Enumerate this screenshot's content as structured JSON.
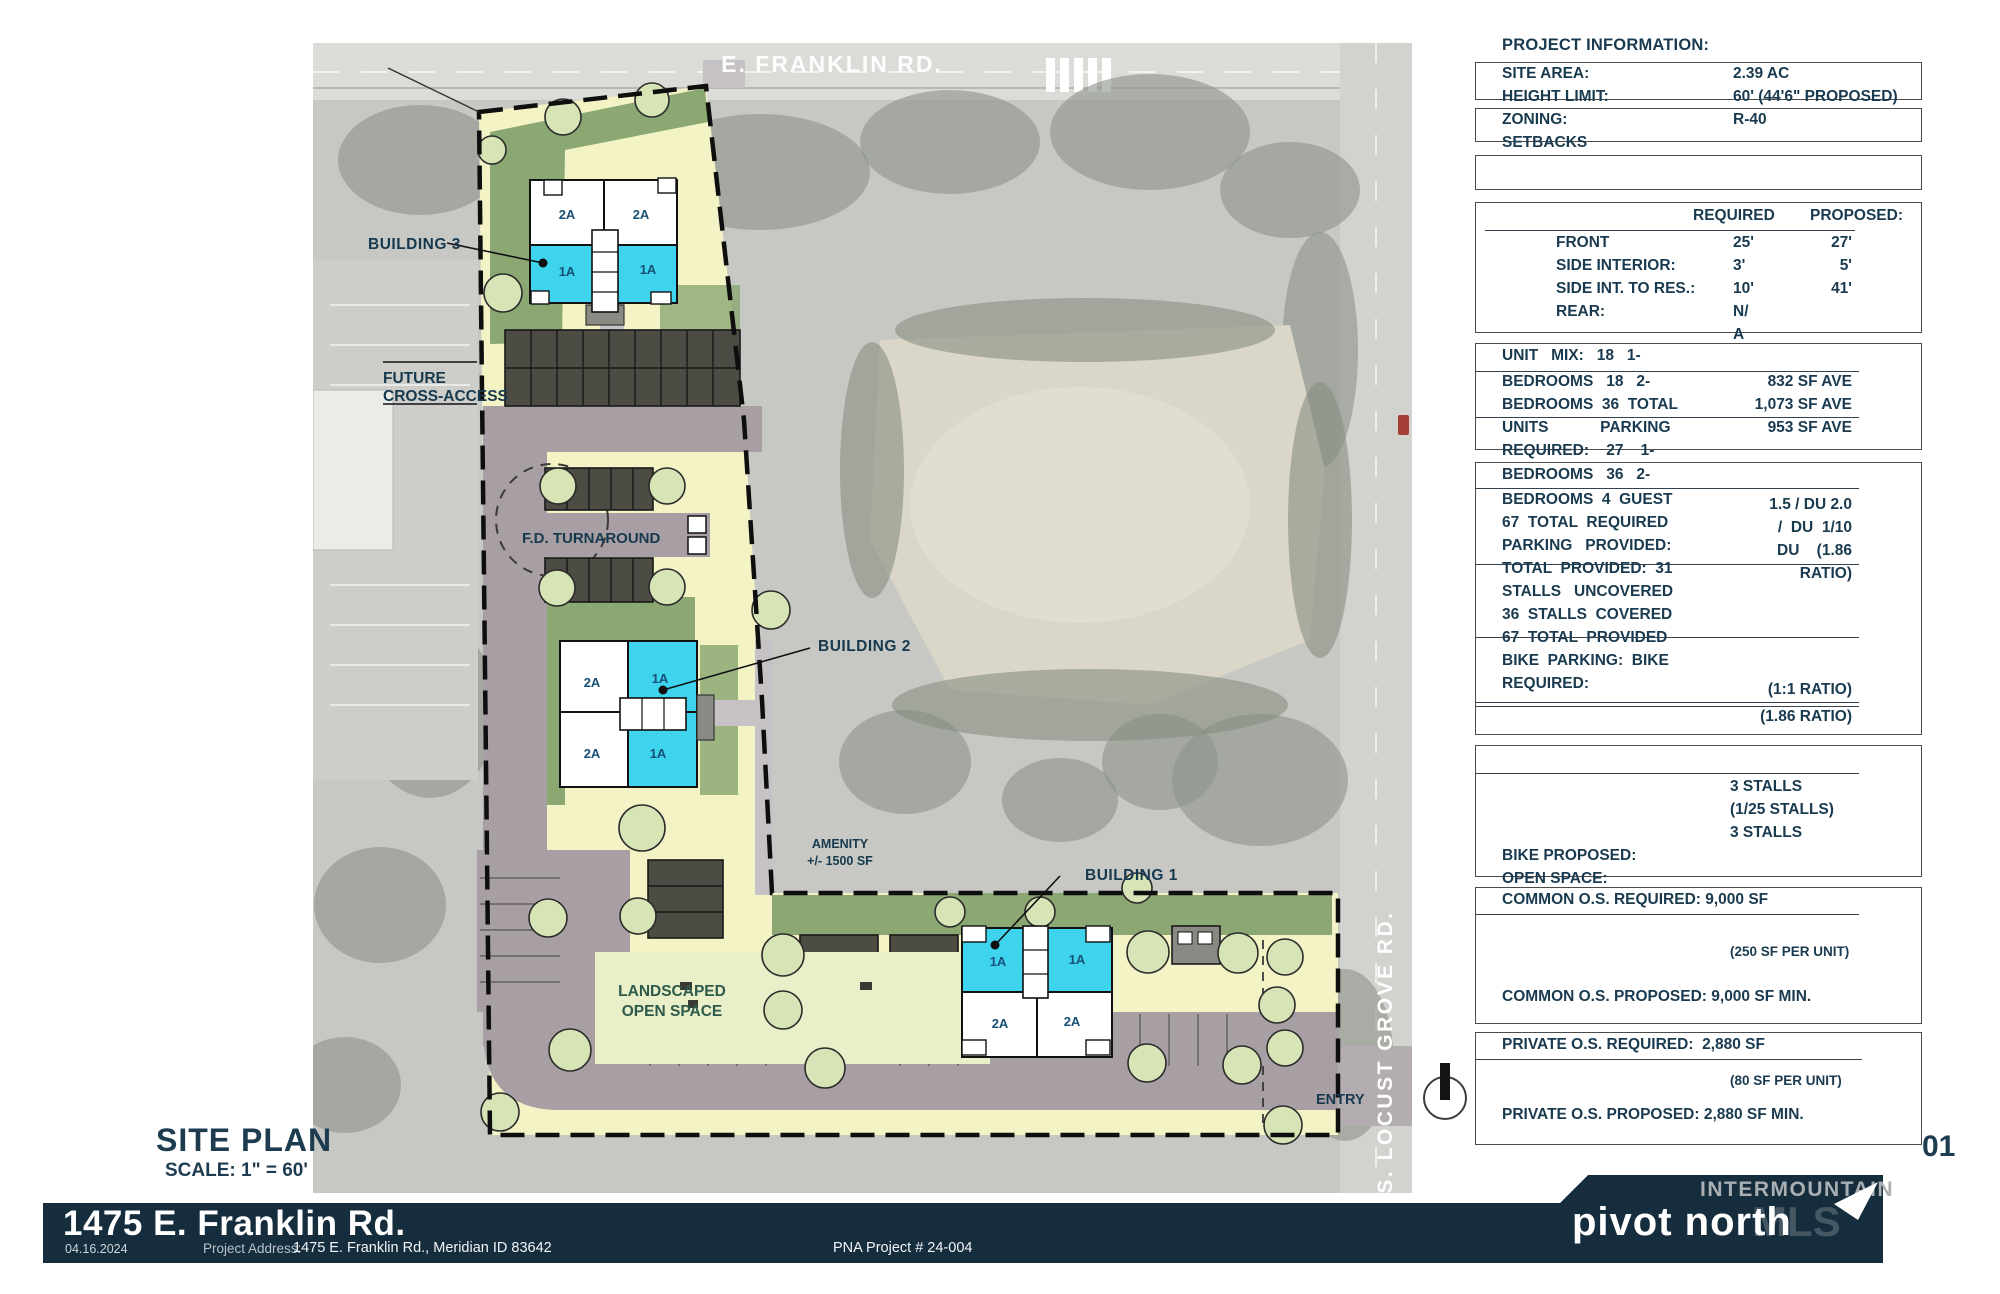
{
  "sheet": {
    "title": "SITE PLAN",
    "scale": "SCALE: 1\" = 60'",
    "sheet_number": "01",
    "date": "04.16.2024",
    "project_title": "1475 E. Franklin Rd.",
    "address_label": "Project Address:",
    "address": "1475 E. Franklin Rd., Meridian ID 83642",
    "project_number": "PNA Project # 24-004",
    "logo_text": "pivot north",
    "watermark_line1": "INTERMOUNTAIN",
    "watermark_line2": "MLS"
  },
  "plan": {
    "roads": {
      "top": "E. FRANKLIN RD.",
      "right": "S. LOCUST GROVE RD."
    },
    "labels": {
      "building1": "BUILDING 1",
      "building2": "BUILDING 2",
      "building3": "BUILDING 3",
      "future_line1": "FUTURE",
      "future_line2": "CROSS-ACCESS",
      "fd_turnaround": "F.D. TURNAROUND",
      "amenity_line1": "AMENITY",
      "amenity_line2": "+/- 1500 SF",
      "landscaped_line1": "LANDSCAPED",
      "landscaped_line2": "OPEN SPACE",
      "entry": "ENTRY"
    },
    "units": {
      "oneA": "1A",
      "twoA": "2A"
    },
    "colors": {
      "unit_1a": "#3ed4ee",
      "parcel": "#f4f3c5",
      "drive": "#a89fa4",
      "navy": "#162d3d"
    }
  },
  "panel": {
    "heading": "PROJECT INFORMATION:",
    "info": [
      {
        "label": "SITE AREA:",
        "value": "2.39 AC"
      },
      {
        "label": "HEIGHT LIMIT:",
        "value": "60' (44'6\" PROPOSED)"
      },
      {
        "label": "ZONING:",
        "value": "R-40"
      },
      {
        "label": "SETBACKS",
        "value": ""
      }
    ],
    "setbacks": {
      "col_required": "REQUIRED",
      "col_proposed": "PROPOSED:",
      "rows": [
        {
          "label": "FRONT",
          "required": "25'",
          "proposed": "27'"
        },
        {
          "label": "SIDE INTERIOR:",
          "required": "3'",
          "proposed": "5'"
        },
        {
          "label": "SIDE INT. TO RES.:",
          "required": "10'",
          "proposed": "41'"
        },
        {
          "label": "REAR:",
          "required": "N/",
          "proposed": ""
        },
        {
          "label": "",
          "required": "A",
          "proposed": ""
        }
      ]
    },
    "unit_mix": {
      "lines": [
        "UNIT   MIX:   18   1-",
        "BEDROOMS   18   2-",
        "BEDROOMS  36  TOTAL",
        "UNITS            PARKING",
        "REQUIRED:    27    1-"
      ],
      "values": [
        "832 SF AVE",
        "1,073 SF AVE",
        "953 SF AVE"
      ]
    },
    "parking": {
      "lines": [
        "BEDROOMS   36   2-",
        "BEDROOMS  4  GUEST",
        "67  TOTAL  REQUIRED",
        "PARKING   PROVIDED:",
        "TOTAL  PROVIDED:  31",
        "STALLS   UNCOVERED",
        "36  STALLS  COVERED",
        "67  TOTAL  PROVIDED",
        "BIKE  PARKING:  BIKE",
        "REQUIRED:"
      ],
      "values": [
        "1.5 / DU 2.0",
        "/  DU  1/10",
        "DU    (1.86",
        "RATIO)",
        "(1:1 RATIO)",
        "(1.86 RATIO)"
      ]
    },
    "bike": {
      "values": [
        "3 STALLS",
        "(1/25 STALLS)",
        "3 STALLS"
      ],
      "lines": [
        "BIKE PROPOSED:",
        "OPEN SPACE:"
      ]
    },
    "common_os": {
      "required": "COMMON O.S. REQUIRED: 9,000 SF",
      "per_unit": "(250 SF PER UNIT)",
      "proposed": "COMMON O.S. PROPOSED: 9,000 SF MIN."
    },
    "private_os": {
      "required": "PRIVATE O.S. REQUIRED:  2,880 SF",
      "per_unit": "(80 SF PER UNIT)",
      "proposed": "PRIVATE O.S. PROPOSED: 2,880 SF MIN."
    }
  }
}
